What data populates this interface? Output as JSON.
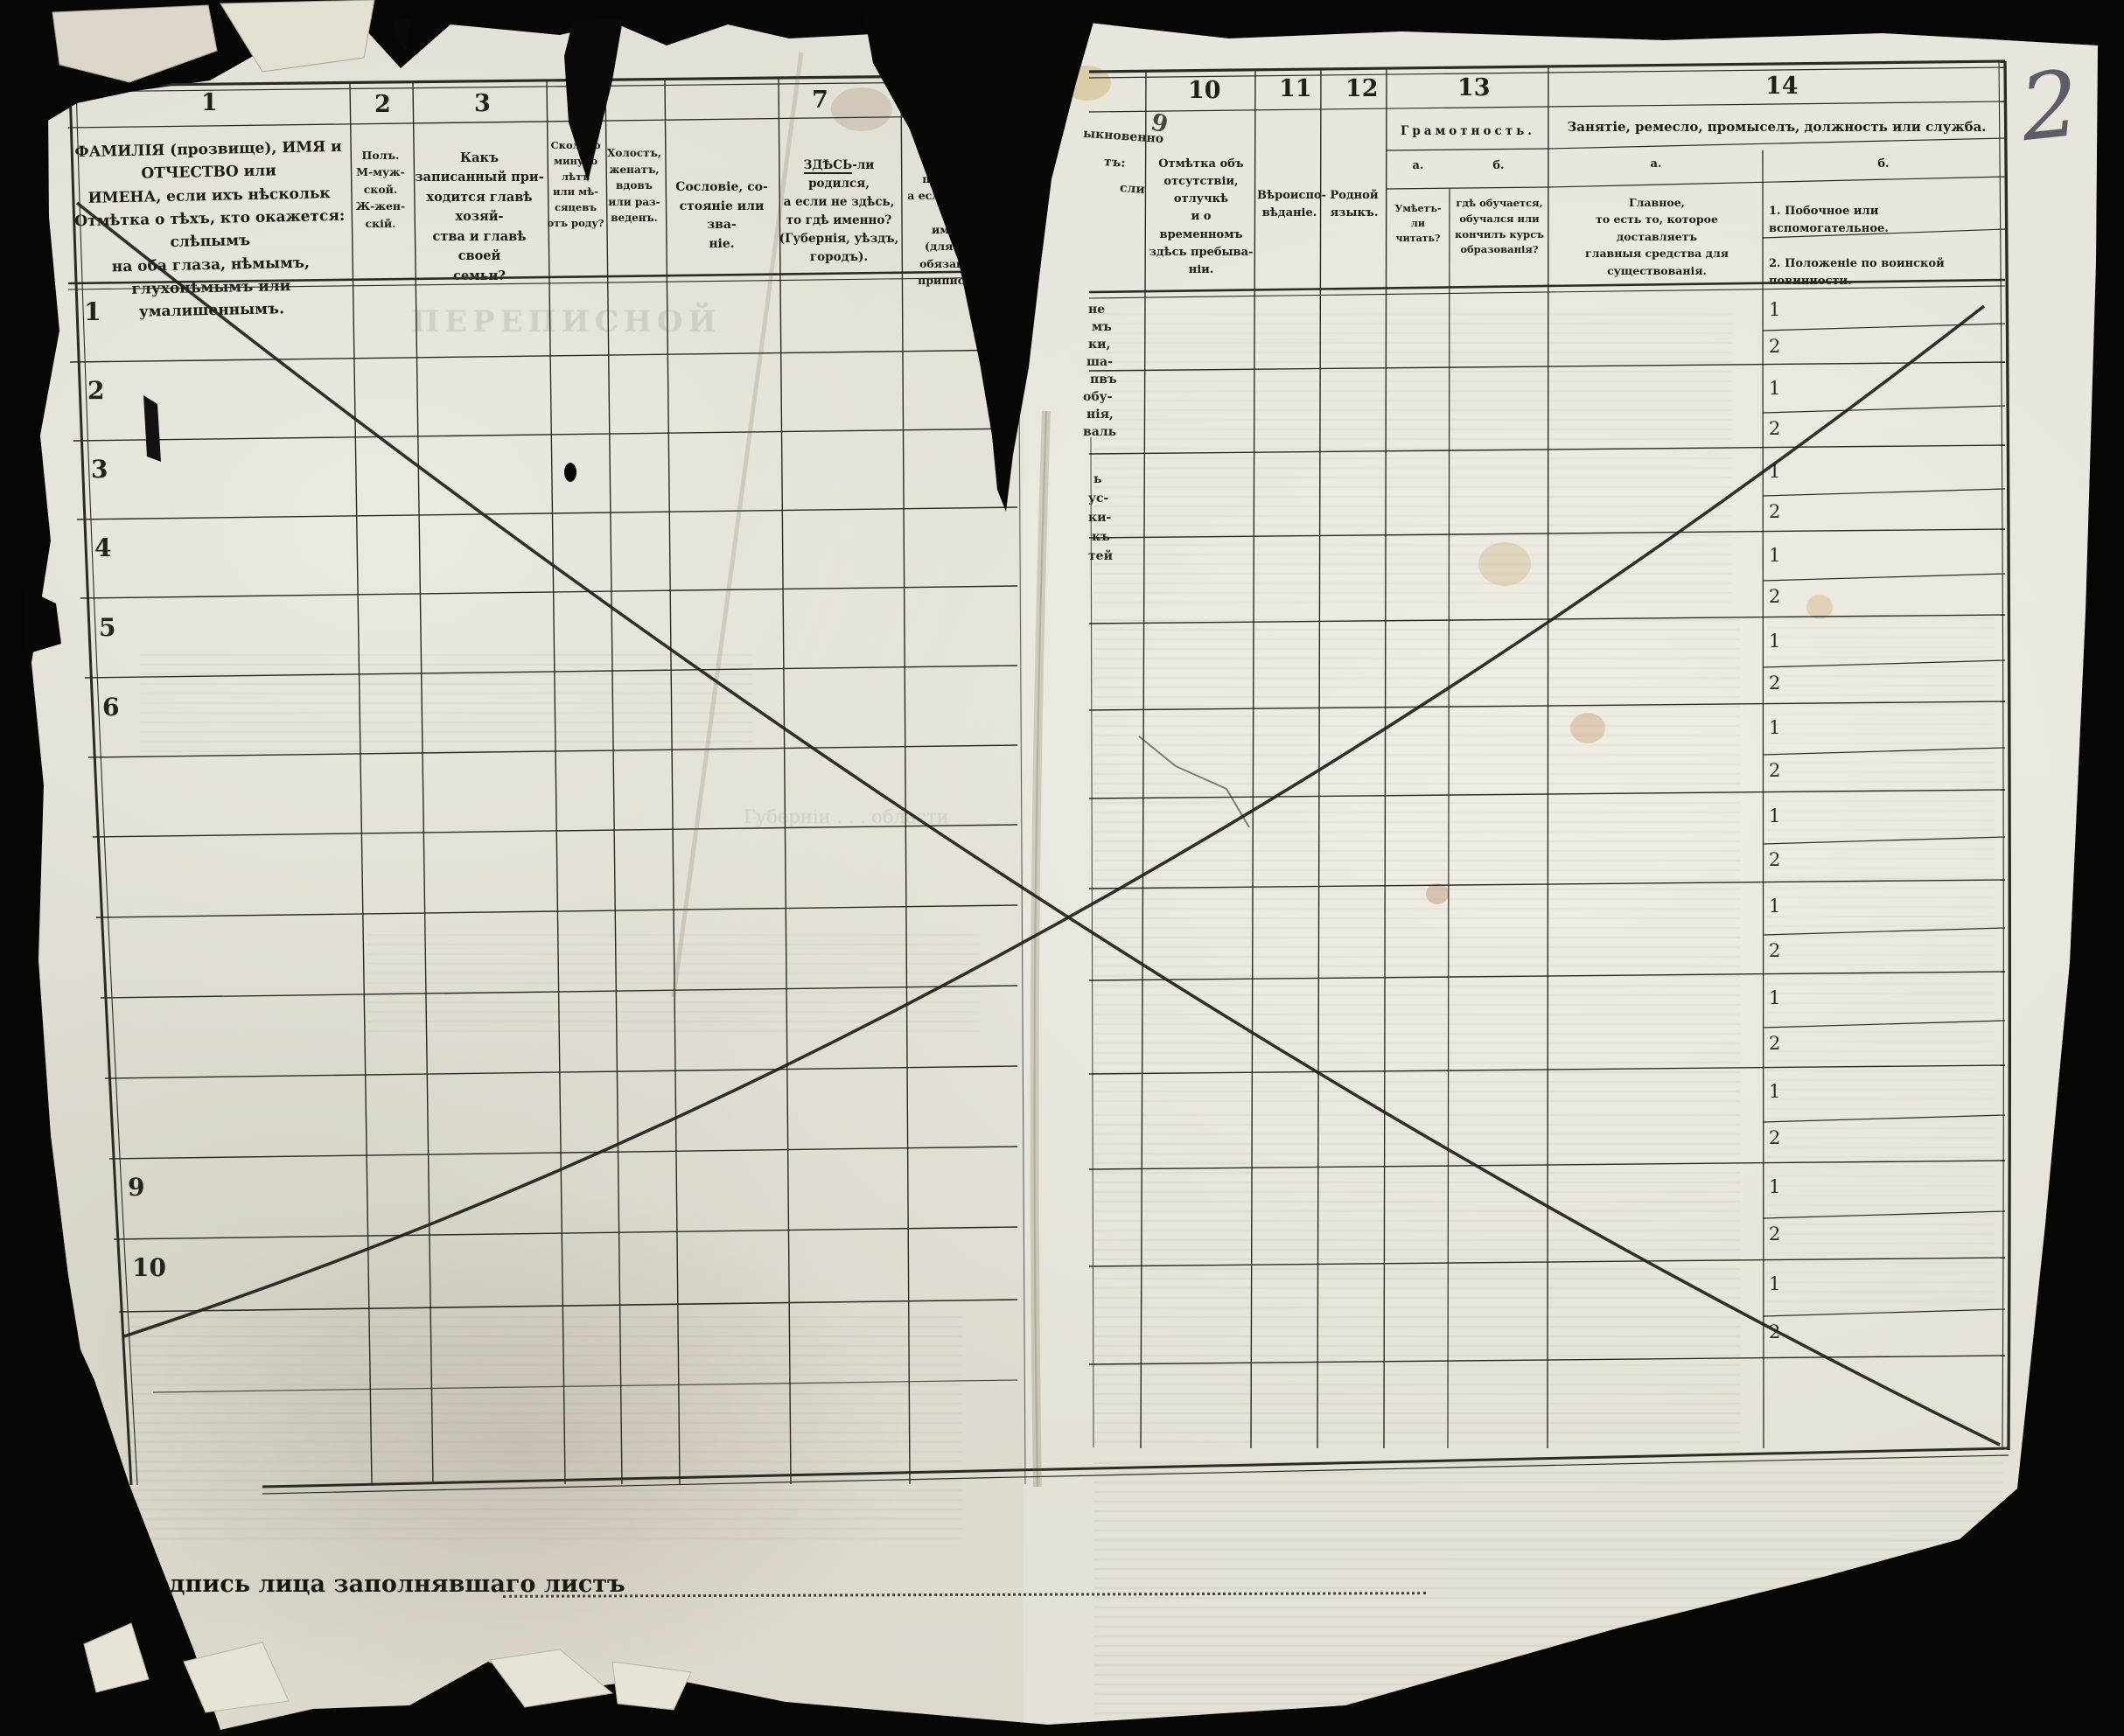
{
  "page_number": "2",
  "footer": {
    "signature_label": "Подпись лица заполнявшаго листъ"
  },
  "handwritten": {
    "page_mark": "2"
  },
  "rows": {
    "left_labels": [
      "1",
      "2",
      "3",
      "4",
      "5",
      "6",
      "",
      "",
      "",
      "",
      "",
      "9",
      "10"
    ],
    "sub_first": "1",
    "sub_second": "2"
  },
  "header": {
    "columns": [
      {
        "num": "1",
        "lines": [
          "ФАМИЛІЯ (прозвище), ИМЯ и ОТЧЕСТВО или",
          "ИМЕНА, если ихъ нѣскольк",
          "Отмѣтка о тѣхъ, кто окажется: слѣпымъ",
          "на оба глаза, нѣмымъ, глухонѣмымъ или",
          "умалишеннымъ."
        ]
      },
      {
        "num": "2",
        "lines": [
          "Полъ.",
          "М-муж-",
          "ской.",
          "Ж-жен-",
          "скій."
        ]
      },
      {
        "num": "3",
        "lines": [
          "Какъ записанный при-",
          "ходится главѣ хозяй-",
          "ства и главѣ своей",
          "семьи?"
        ]
      },
      {
        "num": "4",
        "lines": [
          "Сколько",
          "минуло",
          "лѣтъ",
          "или мѣ-",
          "сяцевъ",
          "отъ роду?"
        ]
      },
      {
        "num": "",
        "lines": [
          "Холостъ,",
          "женатъ,",
          "вдовъ",
          "или раз-",
          "веденъ."
        ]
      },
      {
        "num": "",
        "lines": [
          "Сословіе, со-",
          "стояніе или зва-",
          "ніе."
        ]
      },
      {
        "num": "7",
        "first_word": "ЗДѢСЬ",
        "first_rest": "-ли родился,",
        "lines": [
          "а если не здѣсь,",
          "то гдѣ именно?",
          "(Губернія, уѣздъ, городъ)."
        ]
      },
      {
        "num": "8",
        "first_word": "ЗДѢСЬ",
        "first_rest": "-ли прописанъ,",
        "lines": [
          "а если не здѣсь, то",
          "именно?",
          "(для лицъ, обязанныхъ",
          "припискою)."
        ]
      },
      {
        "num": "9",
        "fragments": [
          "ыкновенно",
          "тъ:",
          "сли"
        ]
      },
      {
        "num": "10",
        "lines": [
          "Отмѣтка объ",
          "отсутствіи, отлучкѣ",
          "и о временномъ",
          "здѣсь пребыва-",
          "ніи."
        ]
      },
      {
        "num": "11",
        "lines": [
          "Вѣроиспо-",
          "вѣданіе."
        ]
      },
      {
        "num": "12",
        "lines": [
          "Родной",
          "языкъ."
        ]
      },
      {
        "num": "13",
        "title": "Грамотность.",
        "a_label": "а.",
        "b_label": "б.",
        "a_lines": [
          "Умѣетъ-",
          "ли",
          "читать?"
        ],
        "b_lines": [
          "гдѣ обучается,",
          "обучался или",
          "кончилъ курсъ",
          "образованія?"
        ]
      },
      {
        "num": "14",
        "title": "Занятіе, ремесло, промыселъ, должность или служба.",
        "a_label": "а.",
        "b_label": "б.",
        "a_lines": [
          "Главное,",
          "то есть то, которое доставляетъ",
          "главныя средства для существованія."
        ],
        "b_item1": "1.  Побочное или  вспомогательное.",
        "b_item2": "2.  Положеніе по воинской повинности."
      }
    ]
  },
  "tear_fragments": [
    "не",
    "мъ",
    "ки,",
    "ша-",
    "пвъ",
    "обу-",
    "нія,",
    "валь",
    "ь",
    "ус-",
    "ки-",
    "къ",
    "тей"
  ],
  "ghost_texts": {
    "title_bleed": "ПЕРЕПИСНОЙ",
    "province_bleed": "Губерніи  .  .  .  области"
  },
  "colors": {
    "paper": "#e3e0d7",
    "ink": "#1d1b15",
    "background": "#060605"
  }
}
